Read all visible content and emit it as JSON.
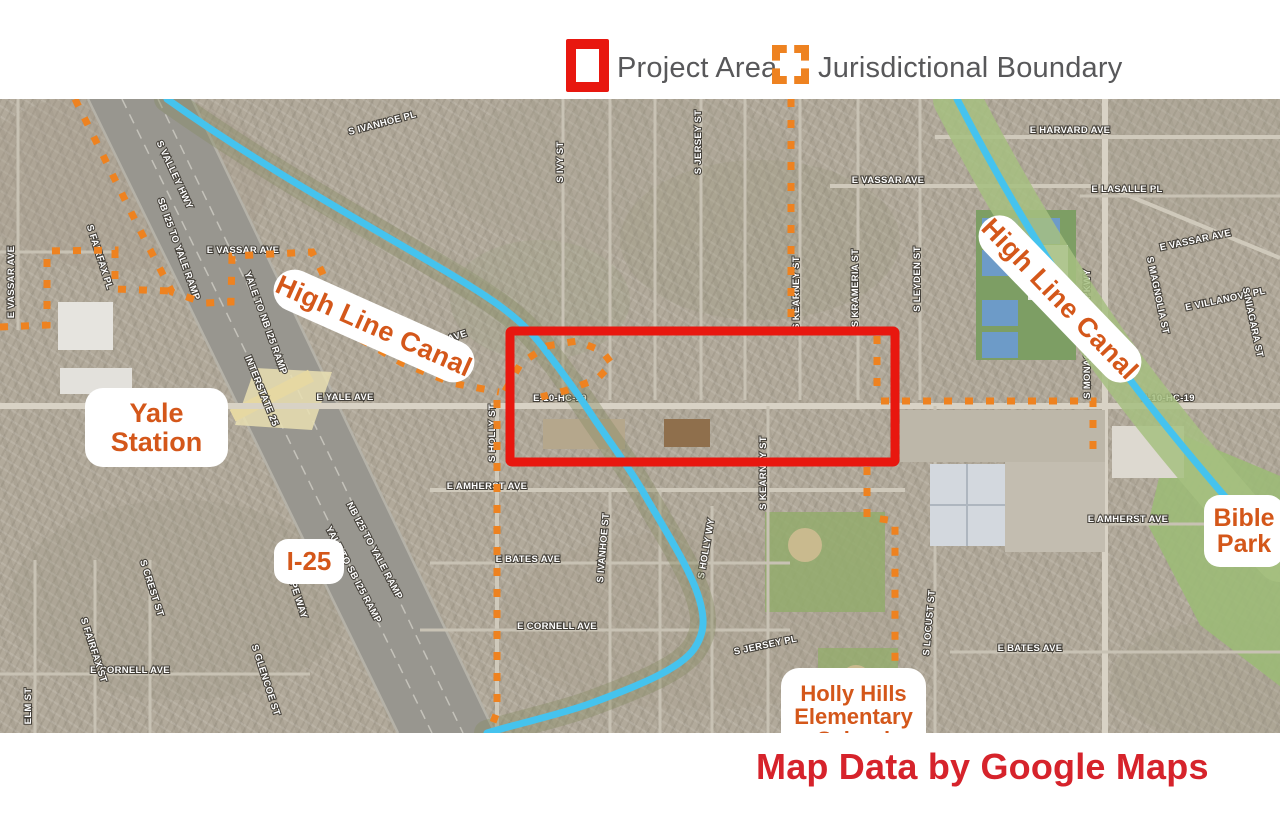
{
  "legend": {
    "items": [
      {
        "label": "Project Area",
        "style": "solid-red-square"
      },
      {
        "label": "Jurisdictional Boundary",
        "style": "dashed-orange-square"
      }
    ]
  },
  "annotations": {
    "canal_label_west": "High Line Canal",
    "canal_label_east": "High Line Canal",
    "yale_line1": "Yale",
    "yale_line2": "Station",
    "i25": "I-25",
    "holly_line1": "Holly Hills",
    "holly_line2": "Elementary",
    "holly_line3": "School",
    "bible_line1": "Bible",
    "bible_line2": "Park"
  },
  "credit": "Map Data by Google Maps",
  "colors": {
    "project_area_red": "#e8170f",
    "boundary_orange": "#ee8220",
    "canal_blue": "#45c3ee",
    "label_orange": "#d4571a",
    "credit_red": "#d6232b",
    "legend_text_gray": "#58585a"
  },
  "map_geometry": {
    "project_rect": {
      "x": 510,
      "y": 331,
      "w": 385,
      "h": 131
    },
    "canals": [
      {
        "id": "high-line-canal-west",
        "d": "M167,99 C260,165 350,215 430,262 C490,297 522,318 545,350 C567,378 580,397 595,420 C617,452 632,472 646,497 C662,525 686,562 697,592 C706,618 705,633 694,649 C680,669 638,686 589,704 C558,715 520,723 487,733",
        "green": "#868b64",
        "green_w": 26,
        "green_op": 0.4
      },
      {
        "id": "high-line-canal-east",
        "d": "M957,99 C1008,198 1058,278 1104,344 C1149,408 1200,468 1246,521 L1280,558",
        "green": "#a6bf80",
        "green_w": 48,
        "green_op": 0.85
      }
    ],
    "boundary_paths": [
      "M75,99 L140,230 L172,292 L205,303 L231,302 L232,256 L312,252 L322,272 L338,310 L362,340 L402,363 L452,383 L499,392",
      "M505,391 L521,363 L547,346 L577,341 L602,351 L612,364 L597,379 L568,390 L541,397",
      "M497,400 L497,712 L489,733",
      "M791,99 L791,330",
      "M877,336 L877,398",
      "M881,401 L1093,401 L1093,461",
      "M867,467 L867,517 L895,521 L895,733",
      "M0,327 L47,325 L47,251 L115,250 L115,289 L170,291"
    ],
    "streets": [
      {
        "name": "S IVANHOE PL",
        "x": 383,
        "y": 126,
        "r": -15
      },
      {
        "name": "S IVY ST",
        "x": 563,
        "y": 162,
        "r": -90
      },
      {
        "name": "S JERSEY ST",
        "x": 701,
        "y": 142,
        "r": -90
      },
      {
        "name": "E VASSAR AVE",
        "x": 888,
        "y": 183,
        "r": 0
      },
      {
        "name": "E HARVARD AVE",
        "x": 1070,
        "y": 133,
        "r": 0
      },
      {
        "name": "E LASALLE PL",
        "x": 1127,
        "y": 192,
        "r": 0
      },
      {
        "name": "E VASSAR AVE",
        "x": 1196,
        "y": 243,
        "r": -12
      },
      {
        "name": "S MAGNOLIA ST",
        "x": 1155,
        "y": 296,
        "r": 78
      },
      {
        "name": "E VILLANOVA PL",
        "x": 1226,
        "y": 302,
        "r": -12
      },
      {
        "name": "S NIAGARA ST",
        "x": 1250,
        "y": 323,
        "r": 78
      },
      {
        "name": "S VALLEY HWY",
        "x": 172,
        "y": 176,
        "r": 65
      },
      {
        "name": "SB I25 TO YALE RAMP",
        "x": 176,
        "y": 250,
        "r": 70
      },
      {
        "name": "YALE TO NB I25 RAMP",
        "x": 263,
        "y": 324,
        "r": 70
      },
      {
        "name": "INTERSTATE 25",
        "x": 259,
        "y": 392,
        "r": 68
      },
      {
        "name": "E VASSAR AVE",
        "x": 243,
        "y": 253,
        "r": 0
      },
      {
        "name": "E VASSAR AVE",
        "x": 433,
        "y": 347,
        "r": -18
      },
      {
        "name": "E VASSAR AVE",
        "x": 14,
        "y": 282,
        "r": -90
      },
      {
        "name": "S FAIRFAX PL",
        "x": 97,
        "y": 258,
        "r": 72
      },
      {
        "name": "E YALE AVE",
        "x": 345,
        "y": 400,
        "r": 0
      },
      {
        "name": "E-10-HC-19",
        "x": 560,
        "y": 401,
        "r": 0
      },
      {
        "name": "E-10-HC-19",
        "x": 1168,
        "y": 401,
        "r": 0
      },
      {
        "name": "S KEARNEY ST",
        "x": 799,
        "y": 293,
        "r": -90
      },
      {
        "name": "S KRAMERIA ST",
        "x": 858,
        "y": 288,
        "r": -90
      },
      {
        "name": "S LEYDEN ST",
        "x": 920,
        "y": 279,
        "r": -90
      },
      {
        "name": "S MONACO STREET PKWY",
        "x": 1090,
        "y": 334,
        "r": -90
      },
      {
        "name": "S HOLLY ST",
        "x": 495,
        "y": 433,
        "r": -90
      },
      {
        "name": "E AMHERST AVE",
        "x": 487,
        "y": 489,
        "r": 0
      },
      {
        "name": "E AMHERST AVE",
        "x": 1128,
        "y": 522,
        "r": 0
      },
      {
        "name": "E BATES AVE",
        "x": 528,
        "y": 562,
        "r": 0
      },
      {
        "name": "E BATES AVE",
        "x": 1030,
        "y": 651,
        "r": 0
      },
      {
        "name": "E CORNELL AVE",
        "x": 557,
        "y": 629,
        "r": 0
      },
      {
        "name": "E CORNELL AVE",
        "x": 130,
        "y": 673,
        "r": 0
      },
      {
        "name": "S IVANHOE ST",
        "x": 606,
        "y": 548,
        "r": -85
      },
      {
        "name": "S HOLLY WY",
        "x": 709,
        "y": 549,
        "r": -80
      },
      {
        "name": "S KEARNEY ST",
        "x": 766,
        "y": 473,
        "r": -90
      },
      {
        "name": "S LOCUST ST",
        "x": 932,
        "y": 623,
        "r": -85
      },
      {
        "name": "S JERSEY PL",
        "x": 766,
        "y": 648,
        "r": -12
      },
      {
        "name": "ELM ST",
        "x": 31,
        "y": 706,
        "r": -90
      },
      {
        "name": "S FAIRFAX ST",
        "x": 91,
        "y": 651,
        "r": 72
      },
      {
        "name": "S CREST ST",
        "x": 149,
        "y": 589,
        "r": 72
      },
      {
        "name": "S GRAPE WAY",
        "x": 291,
        "y": 586,
        "r": 72
      },
      {
        "name": "S GLENCOE ST",
        "x": 263,
        "y": 681,
        "r": 72
      },
      {
        "name": "NB I25 TO YALE RAMP",
        "x": 372,
        "y": 552,
        "r": 62
      },
      {
        "name": "YALE TO SB I25 RAMP",
        "x": 351,
        "y": 576,
        "r": 62
      }
    ]
  }
}
